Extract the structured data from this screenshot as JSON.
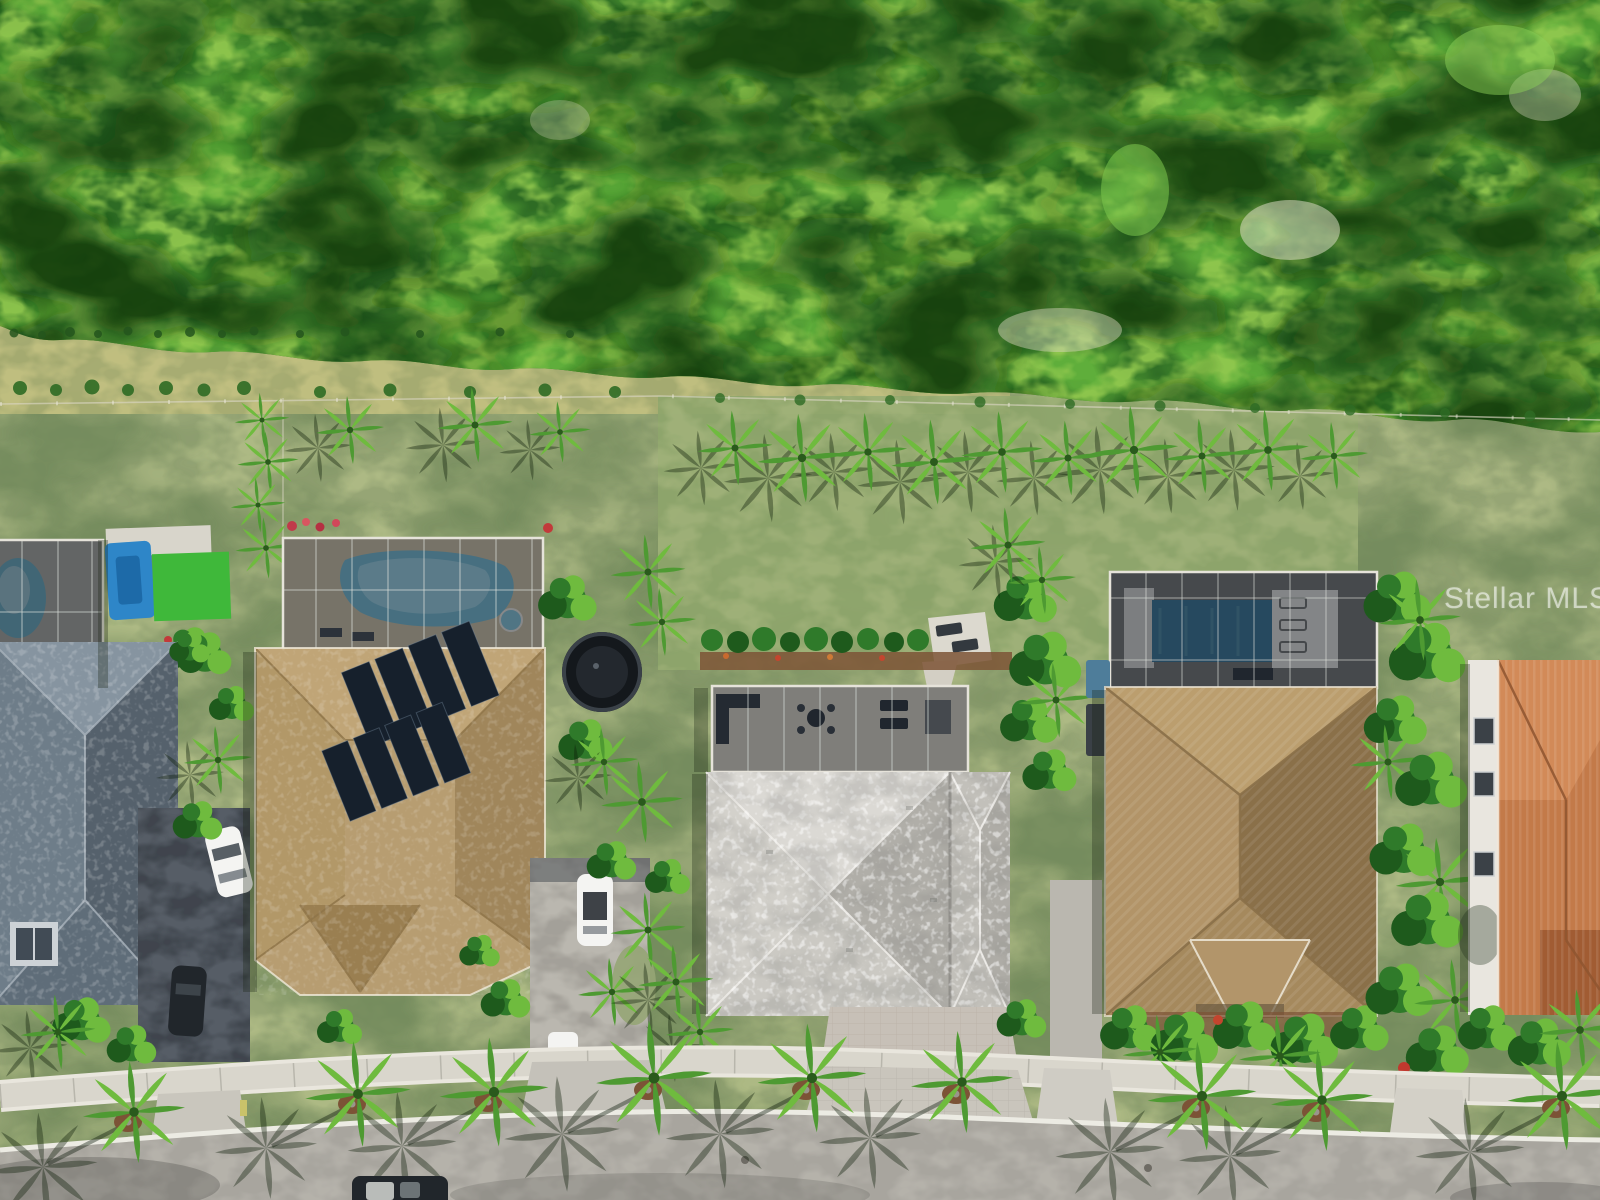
{
  "image": {
    "type": "aerial-drone-photograph",
    "description": "Overhead aerial view of a row of Florida single-family homes with screened pools, palm-lined backyards, driveways and a curved street, backed by a dense green preserve",
    "watermark": "Stellar MLS"
  },
  "palette": {
    "forest-base": "#2e6b24",
    "forest-light": "#5fae3a",
    "forest-lime": "#93c94f",
    "forest-dark": "#16410f",
    "grass": "#96a575",
    "grass-light": "#b3bf88",
    "grass-dark": "#70885a",
    "dry-grass": "#a9ad72",
    "lawn-back": "#8ea56b",
    "screen": "#1d242e",
    "frame": "#e6e3da",
    "pool": "#6db5cc",
    "pool-deep": "#2e6e90",
    "roof1": "#5e6f7d",
    "roof2": "#b79d71",
    "roof2-dark": "#a0865b",
    "roof3": "#c9c7c1",
    "roof3-light": "#dbd9d4",
    "roof3-dark": "#b0aea8",
    "roof4": "#ab8f62",
    "roof4-dark": "#8a7049",
    "roof5": "#c37a49",
    "roof5-dark": "#a15c33",
    "solar": "#16202c",
    "street": "#a8a59e",
    "sidewalk": "#d9d6cc",
    "curb": "#ecebe3",
    "drive-dark": "#565d66",
    "drive-light": "#bab7af",
    "paver": "#c9c5bc",
    "car-white": "#f4f4f2",
    "car-dark": "#21262b",
    "palm1": "#4e9a32",
    "palm2": "#6fbb3e",
    "bush": "#2f7a2a",
    "mulch": "#7c5336",
    "turf": "#3fb83a",
    "slide": "#2e86c8",
    "wall-white": "#e9e6df"
  },
  "scene": {
    "preserve": "dense tree preserve behind homes",
    "houses": [
      {
        "id": "house-1",
        "roof": "gray tile",
        "features": [
          "screened pool",
          "blue play structure",
          "artificial turf",
          "white car",
          "dark car in driveway"
        ]
      },
      {
        "id": "house-2",
        "roof": "tan tile",
        "features": [
          "screened pool and spa",
          "rooftop solar panels",
          "trampoline",
          "white suv",
          "white pickup in driveway"
        ]
      },
      {
        "id": "house-3",
        "roof": "light gray tile",
        "features": [
          "screened lanai with outdoor furniture",
          "large back lawn",
          "palm tree row",
          "hedge row",
          "paver patio with two loungers",
          "paver driveway"
        ]
      },
      {
        "id": "house-4",
        "roof": "brown tile",
        "features": [
          "screened pool enclosure",
          "rectangular pool",
          "white sun deck with loungers"
        ]
      },
      {
        "id": "house-5",
        "roof": "terracotta barrel tile",
        "features": [
          "partially visible at right edge",
          "white side wall with windows"
        ]
      }
    ],
    "street": {
      "sidewalk": "curved concrete sidewalk",
      "trees": "royal palms with circular mulch rings casting long shadows",
      "vehicles": [
        "dark vehicle partially visible at bottom edge"
      ]
    }
  }
}
